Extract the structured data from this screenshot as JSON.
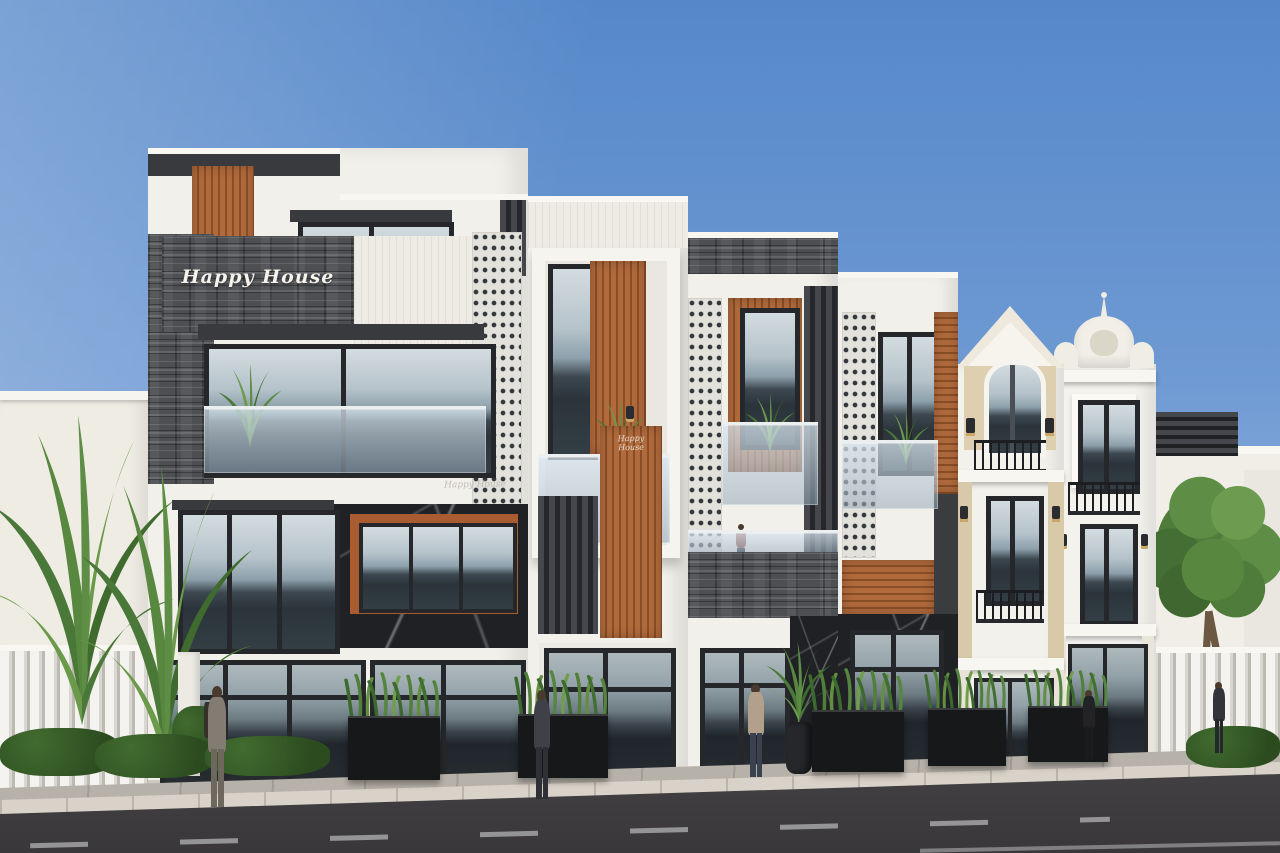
{
  "scene": {
    "type": "3D architectural exterior render",
    "setting": "Street elevation of a row of townhouses under a clear blue sky",
    "description": "Four contemporary shophouses with stone, timber and glass facades beside two ornate neoclassical houses; sidewalk planters, pedestrians and an asphalt road in the foreground",
    "time_of_day": "day"
  },
  "signage": {
    "main_sign": "Happy House",
    "secondary_sign": "Happy House",
    "door_sign": "Happy House"
  },
  "palette": {
    "sky_top": "#5688c9",
    "sky_horizon": "#b9cfe8",
    "facade_white": "#f2f0ea",
    "stone_gray": "#4d4f53",
    "timber": "#a85c30",
    "marble_black": "#1f2125",
    "frame_dark": "#26272a",
    "glass_light": "#c9d4da",
    "glass_dark": "#2b343b",
    "classical_tan": "#d8c9a8",
    "fence_white": "#efeeea",
    "sidewalk": "#b7b2a9",
    "curb": "#d8d2c8",
    "road": "#413f42",
    "foliage": "#4e7b3a"
  },
  "buildings": [
    {
      "id": "townhouse-1",
      "style": "modern",
      "floors": 4,
      "sign": "Happy House",
      "features": [
        "stacked-stone feature wall with script sign",
        "vertical timber slats",
        "glass balustrade balcony",
        "black marble panel with timber-framed window",
        "full-height glazed shopfront"
      ]
    },
    {
      "id": "townhouse-2",
      "style": "modern",
      "floors": 3,
      "features": [
        "projecting white window frame",
        "timber slat infill",
        "glass balcony",
        "dark louvre screen",
        "timber entry panel with wall sconce"
      ]
    },
    {
      "id": "townhouse-3",
      "style": "modern",
      "floors": 3,
      "features": [
        "perforated breeze-block screen",
        "timber slat facade",
        "stone-clad balcony",
        "glazed entry with black marble surround"
      ]
    },
    {
      "id": "townhouse-4",
      "style": "modern",
      "floors": 3,
      "features": [
        "breeze-block strip",
        "horizontal timber cladding",
        "glass balustrade with planting",
        "black marble shopfront"
      ]
    },
    {
      "id": "townhouse-5",
      "style": "neoclassical",
      "floors": 3,
      "features": [
        "arched gable pediment",
        "arched window",
        "wrought-iron balconies",
        "beige pilasters",
        "coach lanterns"
      ]
    },
    {
      "id": "townhouse-6",
      "style": "neoclassical baroque",
      "floors": 3,
      "features": [
        "curved pediment with finial spire",
        "stucco cartouche ornament",
        "wrought-iron balconies",
        "moulded cornices"
      ]
    }
  ],
  "background": {
    "left": "white boundary wall with palm plants and white slatted fence",
    "right": "white house with rooftop louvre box behind a slatted fence, large street tree and hedge"
  },
  "street": {
    "pedestrians": [
      {
        "location": "left sidewalk",
        "appearance": "man in gray suit with backpack"
      },
      {
        "location": "in front of townhouse 2",
        "appearance": "man in dark suit"
      },
      {
        "location": "in front of townhouse 3",
        "appearance": "person in beige coat"
      },
      {
        "location": "in front of classical townhouse",
        "appearance": "woman in black outfit"
      },
      {
        "location": "far right sidewalk",
        "appearance": "man in dark suit"
      }
    ],
    "balcony_occupant": "figure standing at townhouse-3 balcony",
    "planter_boxes": 5,
    "vase_planters": 1,
    "road_marking": "dashed white lane line"
  },
  "vegetation": {
    "palm_clusters_left": 2,
    "street_tree_right": 1,
    "hedges": 2,
    "balcony_plants": 5
  }
}
